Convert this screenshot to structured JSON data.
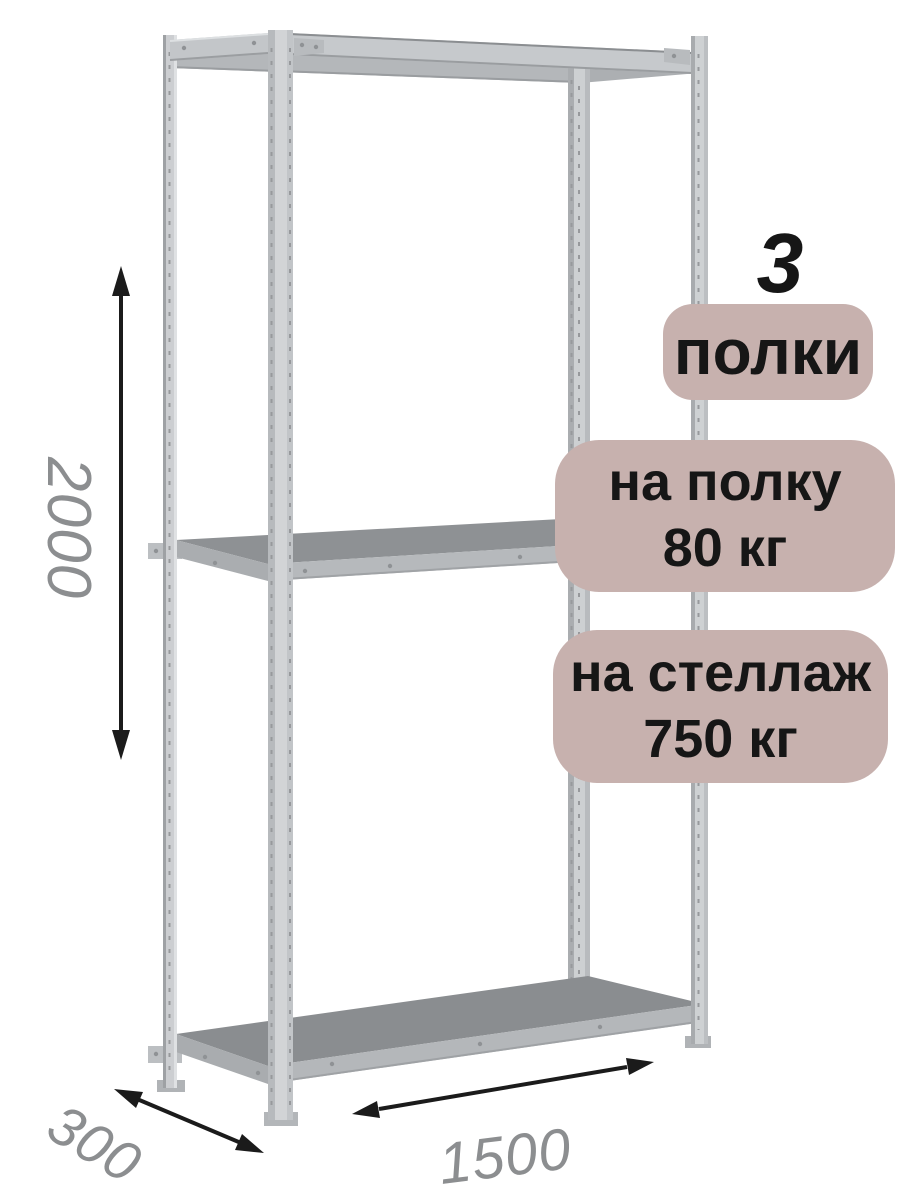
{
  "badges": {
    "shelf_count": {
      "number": "3",
      "label": "полки"
    },
    "per_shelf": {
      "line1": "на полку",
      "line2": "80 кг"
    },
    "per_rack": {
      "line1": "на стеллаж",
      "line2": "750 кг"
    }
  },
  "dimensions": {
    "height": "2000",
    "depth": "300",
    "width": "1500"
  },
  "illustration": {
    "subject": "metal-shelving-rack-three-shelves",
    "shelf_count_shown": 3
  },
  "theme": {
    "background": "#ffffff",
    "badge_bg": "#c7b1ae",
    "badge_text": "#161616",
    "dim_text": "#8c8e90",
    "arrow": "#1b1b1b"
  }
}
